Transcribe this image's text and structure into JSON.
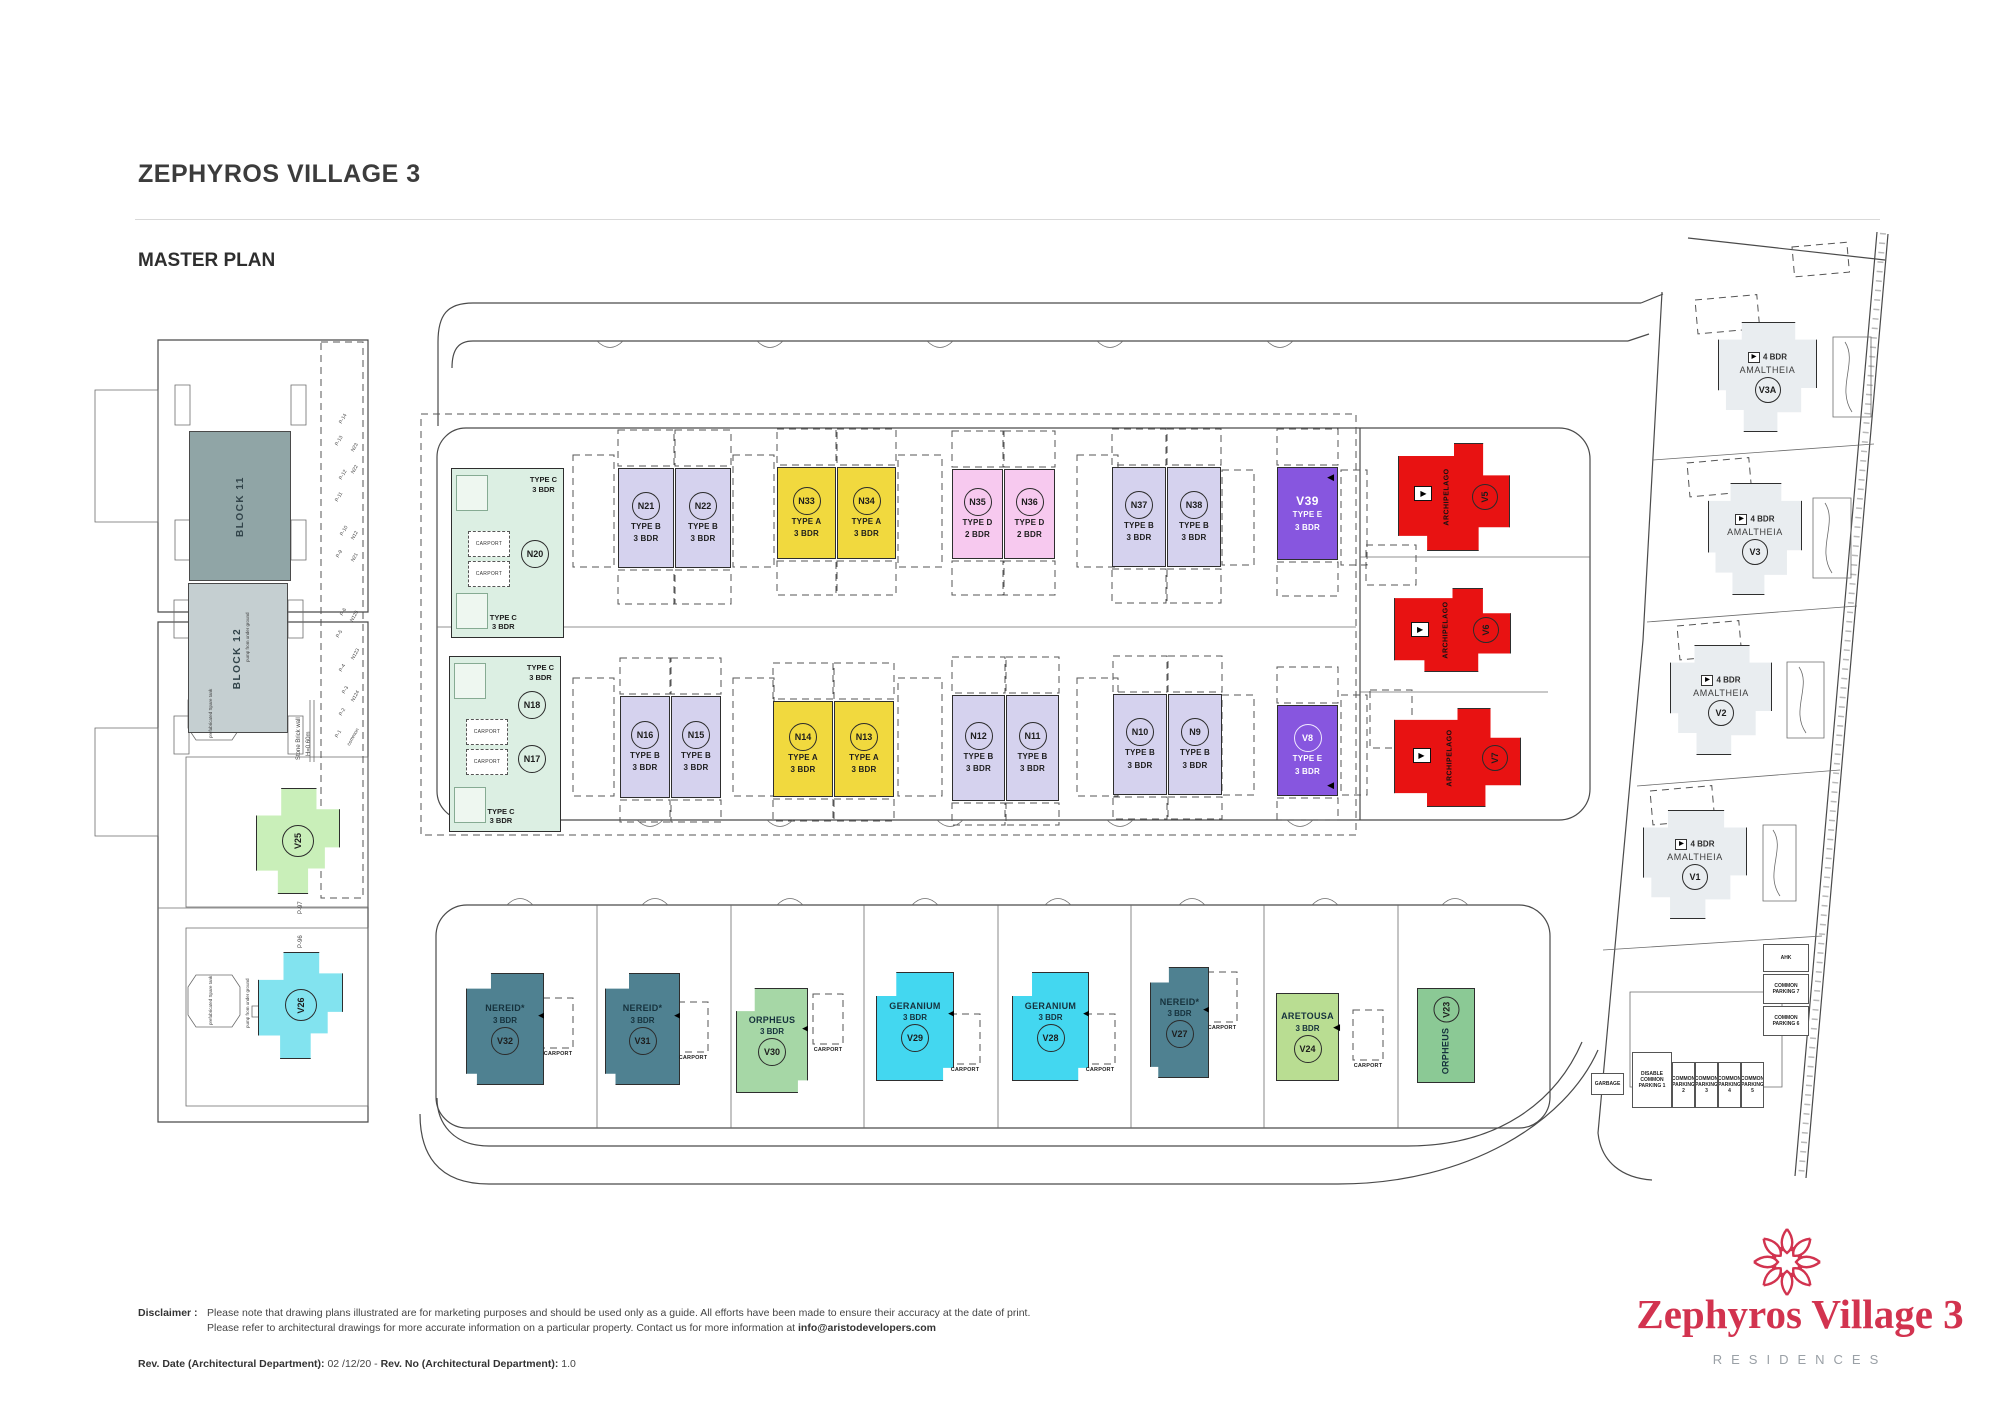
{
  "header": {
    "title": "ZEPHYROS VILLAGE 3",
    "subtitle": "MASTER PLAN"
  },
  "footer": {
    "disclaimer_label": "Disclaimer :",
    "disclaimer_line1": "Please note that drawing plans illustrated are for marketing purposes and should be used only as a guide. All efforts have been made to ensure their accuracy at the date of print.",
    "disclaimer_line2_pre": "Please refer to architectural drawings for more accurate information on a particular property. Contact us for more information at ",
    "disclaimer_email": "info@aristodevelopers.com",
    "rev_date_label": "Rev. Date (Architectural Department): ",
    "rev_date_value": "02 /12/20 - ",
    "rev_no_label": "Rev. No (Architectural Department): ",
    "rev_no_value": "1.0"
  },
  "logo": {
    "name": "Zephyros Village 3",
    "tagline": "RESIDENCES",
    "color": "#d2334f"
  },
  "plan": {
    "colors": {
      "A": "#f1d93e",
      "B": "#d5d2ee",
      "C": "#dcefe3",
      "D": "#f7c9ef",
      "E": "#8756df",
      "red": "#e81212",
      "nereid": "#4f8191",
      "orpheus": "#a6d7a6",
      "orpheus2": "#8bc995",
      "geranium": "#43d7f0",
      "aretousa": "#b9dd92",
      "v25": "#c9efb9",
      "v26": "#82e3ef",
      "amal": "#e9edf0",
      "block11": "#90a5a6",
      "block12": "#c5cfd1"
    },
    "carport_label": "CARPORT",
    "typec_label": [
      "TYPE C",
      "3 BDR"
    ],
    "typec_clusters": [
      {
        "x": 451,
        "y": 468,
        "w": 113,
        "h": 170,
        "codes": [
          "N20"
        ]
      },
      {
        "x": 449,
        "y": 656,
        "w": 112,
        "h": 176,
        "codes": [
          "N18",
          "N17"
        ]
      }
    ],
    "blocks": [
      {
        "label": "BLOCK 11",
        "x": 189,
        "y": 431,
        "w": 102,
        "h": 150,
        "color": "block11"
      },
      {
        "label": "BLOCK 12",
        "x": 188,
        "y": 583,
        "w": 100,
        "h": 150,
        "color": "block12"
      }
    ],
    "units": [
      {
        "code": "N21",
        "kind": "row",
        "deck": true,
        "x": 618,
        "y": 468,
        "w": 56,
        "h": 100,
        "color": "B",
        "lines": [
          "TYPE B",
          "3 BDR"
        ]
      },
      {
        "code": "N22",
        "kind": "row",
        "deck": true,
        "x": 675,
        "y": 468,
        "w": 56,
        "h": 100,
        "color": "B",
        "lines": [
          "TYPE B",
          "3 BDR"
        ]
      },
      {
        "code": "N33",
        "kind": "row",
        "deck": true,
        "x": 777,
        "y": 467,
        "w": 59,
        "h": 92,
        "color": "A",
        "lines": [
          "TYPE A",
          "3 BDR"
        ]
      },
      {
        "code": "N34",
        "kind": "row",
        "deck": true,
        "x": 837,
        "y": 467,
        "w": 59,
        "h": 92,
        "color": "A",
        "lines": [
          "TYPE A",
          "3 BDR"
        ]
      },
      {
        "code": "N35",
        "kind": "row",
        "deck": true,
        "x": 952,
        "y": 469,
        "w": 51,
        "h": 90,
        "color": "D",
        "lines": [
          "TYPE D",
          "2 BDR"
        ]
      },
      {
        "code": "N36",
        "kind": "row",
        "deck": true,
        "x": 1004,
        "y": 469,
        "w": 51,
        "h": 90,
        "color": "D",
        "lines": [
          "TYPE D",
          "2 BDR"
        ]
      },
      {
        "code": "N37",
        "kind": "row",
        "deck": true,
        "x": 1112,
        "y": 467,
        "w": 54,
        "h": 100,
        "color": "B",
        "lines": [
          "TYPE B",
          "3 BDR"
        ]
      },
      {
        "code": "N38",
        "kind": "row",
        "deck": true,
        "x": 1167,
        "y": 467,
        "w": 54,
        "h": 100,
        "color": "B",
        "lines": [
          "TYPE B",
          "3 BDR"
        ]
      },
      {
        "code": "V39",
        "kind": "row",
        "plain": true,
        "light": true,
        "deck": true,
        "x": 1277,
        "y": 467,
        "w": 61,
        "h": 93,
        "color": "E",
        "lines": [
          "TYPE E",
          "3 BDR"
        ],
        "arrow": "tr"
      },
      {
        "code": "N16",
        "kind": "row",
        "deck": true,
        "x": 620,
        "y": 696,
        "w": 50,
        "h": 102,
        "color": "B",
        "lines": [
          "TYPE B",
          "3 BDR"
        ]
      },
      {
        "code": "N15",
        "kind": "row",
        "deck": true,
        "x": 671,
        "y": 696,
        "w": 50,
        "h": 102,
        "color": "B",
        "lines": [
          "TYPE B",
          "3 BDR"
        ]
      },
      {
        "code": "N14",
        "kind": "row",
        "deck": true,
        "x": 773,
        "y": 701,
        "w": 60,
        "h": 96,
        "color": "A",
        "lines": [
          "TYPE A",
          "3 BDR"
        ]
      },
      {
        "code": "N13",
        "kind": "row",
        "deck": true,
        "x": 834,
        "y": 701,
        "w": 60,
        "h": 96,
        "color": "A",
        "lines": [
          "TYPE A",
          "3 BDR"
        ]
      },
      {
        "code": "N12",
        "kind": "row",
        "deck": true,
        "x": 952,
        "y": 695,
        "w": 53,
        "h": 106,
        "color": "B",
        "lines": [
          "TYPE B",
          "3 BDR"
        ]
      },
      {
        "code": "N11",
        "kind": "row",
        "deck": true,
        "x": 1006,
        "y": 695,
        "w": 53,
        "h": 106,
        "color": "B",
        "lines": [
          "TYPE B",
          "3 BDR"
        ]
      },
      {
        "code": "N10",
        "kind": "row",
        "deck": true,
        "x": 1113,
        "y": 694,
        "w": 54,
        "h": 101,
        "color": "B",
        "lines": [
          "TYPE B",
          "3 BDR"
        ]
      },
      {
        "code": "N9",
        "kind": "row",
        "deck": true,
        "x": 1168,
        "y": 694,
        "w": 54,
        "h": 101,
        "color": "B",
        "lines": [
          "TYPE B",
          "3 BDR"
        ]
      },
      {
        "code": "V8",
        "kind": "row",
        "light": true,
        "deck": true,
        "x": 1277,
        "y": 705,
        "w": 61,
        "h": 91,
        "color": "E",
        "lines": [
          "TYPE E",
          "3 BDR"
        ],
        "arrow": "br"
      },
      {
        "code": "V5",
        "kind": "red",
        "x": 1398,
        "y": 443,
        "w": 112,
        "h": 108,
        "color": "red",
        "name": "ARCHIPELAGO",
        "shape": "redshape"
      },
      {
        "code": "V6",
        "kind": "red",
        "x": 1394,
        "y": 588,
        "w": 117,
        "h": 84,
        "color": "red",
        "name": "ARCHIPELAGO",
        "shape": "redshape"
      },
      {
        "code": "V7",
        "kind": "red",
        "x": 1394,
        "y": 708,
        "w": 127,
        "h": 99,
        "color": "red",
        "name": "ARCHIPELAGO",
        "shape": "redshape"
      },
      {
        "code": "V32",
        "kind": "villa",
        "x": 466,
        "y": 973,
        "w": 78,
        "h": 112,
        "color": "nereid",
        "lines": [
          "NEREID*",
          "3 BDR"
        ],
        "shape": "villa",
        "arrow": "right"
      },
      {
        "code": "V31",
        "kind": "villa",
        "x": 605,
        "y": 973,
        "w": 75,
        "h": 112,
        "color": "nereid",
        "lines": [
          "NEREID*",
          "3 BDR"
        ],
        "shape": "villa",
        "arrow": "right"
      },
      {
        "code": "V30",
        "kind": "villa",
        "x": 736,
        "y": 988,
        "w": 72,
        "h": 105,
        "color": "orpheus",
        "lines": [
          "ORPHEUS",
          "3 BDR"
        ],
        "shape": "villa2",
        "arrow": "right"
      },
      {
        "code": "V29",
        "kind": "villa",
        "x": 876,
        "y": 972,
        "w": 78,
        "h": 109,
        "color": "geranium",
        "lines": [
          "GERANIUM",
          "3 BDR"
        ],
        "shape": "villa2",
        "arrow": "right"
      },
      {
        "code": "V28",
        "kind": "villa",
        "x": 1012,
        "y": 972,
        "w": 77,
        "h": 109,
        "color": "geranium",
        "lines": [
          "GERANIUM",
          "3 BDR"
        ],
        "shape": "villa2",
        "arrow": "right"
      },
      {
        "code": "V27",
        "kind": "villa",
        "x": 1150,
        "y": 967,
        "w": 59,
        "h": 111,
        "color": "nereid",
        "lines": [
          "NEREID*",
          "3 BDR"
        ],
        "shape": "villa",
        "arrow": "right"
      },
      {
        "code": "V24",
        "kind": "villa",
        "x": 1276,
        "y": 993,
        "w": 63,
        "h": 88,
        "color": "aretousa",
        "lines": [
          "ARETOUSA",
          "3 BDR"
        ],
        "arrow": "right"
      },
      {
        "code": "V23",
        "kind": "vert",
        "x": 1417,
        "y": 988,
        "w": 58,
        "h": 95,
        "color": "orpheus2",
        "name": "ORPHEUS"
      },
      {
        "code": "V25",
        "kind": "cross",
        "x": 256,
        "y": 788,
        "w": 84,
        "h": 106,
        "color": "v25",
        "shape": "cross"
      },
      {
        "code": "V26",
        "kind": "cross",
        "x": 258,
        "y": 952,
        "w": 85,
        "h": 107,
        "color": "v26",
        "shape": "cross"
      },
      {
        "code": "V3A",
        "kind": "amal",
        "x": 1718,
        "y": 322,
        "w": 99,
        "h": 110,
        "color": "amal",
        "lines": [
          "4 BDR",
          "AMALTHEIA"
        ],
        "shape": "amal"
      },
      {
        "code": "V3",
        "kind": "amal",
        "x": 1708,
        "y": 483,
        "w": 94,
        "h": 112,
        "color": "amal",
        "lines": [
          "4 BDR",
          "AMALTHEIA"
        ],
        "shape": "amal"
      },
      {
        "code": "V2",
        "kind": "amal",
        "x": 1670,
        "y": 645,
        "w": 102,
        "h": 110,
        "color": "amal",
        "lines": [
          "4 BDR",
          "AMALTHEIA"
        ],
        "shape": "amal"
      },
      {
        "code": "V1",
        "kind": "amal",
        "x": 1643,
        "y": 810,
        "w": 104,
        "h": 109,
        "color": "amal",
        "lines": [
          "4 BDR",
          "AMALTHEIA"
        ],
        "shape": "amal"
      }
    ],
    "carports": [
      {
        "x": 558,
        "y": 1054
      },
      {
        "x": 693,
        "y": 1058
      },
      {
        "x": 828,
        "y": 1050
      },
      {
        "x": 965,
        "y": 1070
      },
      {
        "x": 1100,
        "y": 1070
      },
      {
        "x": 1222,
        "y": 1028
      },
      {
        "x": 1368,
        "y": 1066
      }
    ],
    "parking_boxes": [
      {
        "text": "AHK",
        "x": 1763,
        "y": 944,
        "w": 46,
        "h": 28
      },
      {
        "text": "COMMON PARKING 7",
        "x": 1763,
        "y": 974,
        "w": 46,
        "h": 30
      },
      {
        "text": "COMMON PARKING 6",
        "x": 1763,
        "y": 1006,
        "w": 46,
        "h": 30
      },
      {
        "text": "GARBAGE",
        "x": 1591,
        "y": 1073,
        "w": 33,
        "h": 22
      },
      {
        "text": "DISABLE COMMON PARKING 1",
        "x": 1632,
        "y": 1052,
        "w": 40,
        "h": 56
      },
      {
        "text": "COMMON PARKING 2",
        "x": 1672,
        "y": 1062,
        "w": 23,
        "h": 46
      },
      {
        "text": "COMMON PARKING 3",
        "x": 1695,
        "y": 1062,
        "w": 23,
        "h": 46
      },
      {
        "text": "COMMON PARKING 4",
        "x": 1718,
        "y": 1062,
        "w": 23,
        "h": 46
      },
      {
        "text": "COMMON PARKING 5",
        "x": 1741,
        "y": 1062,
        "w": 23,
        "h": 46
      }
    ],
    "small_labels": [
      {
        "t": "Stone Brick wall",
        "x": 296,
        "y": 760,
        "r": -90,
        "s": 6
      },
      {
        "t": "H=0.60m",
        "x": 306,
        "y": 756,
        "r": -90,
        "s": 6
      },
      {
        "t": "P-97",
        "x": 298,
        "y": 914,
        "r": -90,
        "s": 6
      },
      {
        "t": "P-96",
        "x": 298,
        "y": 948,
        "r": -90,
        "s": 6
      },
      {
        "t": "common",
        "x": 346,
        "y": 744,
        "r": -60,
        "s": 5
      },
      {
        "t": "P-1",
        "x": 334,
        "y": 736,
        "r": -60,
        "s": 5
      },
      {
        "t": "P-2",
        "x": 338,
        "y": 714,
        "r": -60,
        "s": 5
      },
      {
        "t": "P-3",
        "x": 341,
        "y": 692,
        "r": -60,
        "s": 5
      },
      {
        "t": "P-4",
        "x": 338,
        "y": 670,
        "r": -60,
        "s": 5
      },
      {
        "t": "N124",
        "x": 350,
        "y": 700,
        "r": -60,
        "s": 5
      },
      {
        "t": "P-5",
        "x": 335,
        "y": 636,
        "r": -60,
        "s": 5
      },
      {
        "t": "P-6",
        "x": 339,
        "y": 614,
        "r": -60,
        "s": 5
      },
      {
        "t": "N123",
        "x": 350,
        "y": 658,
        "r": -60,
        "s": 5
      },
      {
        "t": "N125",
        "x": 349,
        "y": 620,
        "r": -60,
        "s": 5
      },
      {
        "t": "P-9",
        "x": 335,
        "y": 556,
        "r": -60,
        "s": 5
      },
      {
        "t": "P-10",
        "x": 339,
        "y": 534,
        "r": -60,
        "s": 5
      },
      {
        "t": "N21",
        "x": 350,
        "y": 560,
        "r": -60,
        "s": 5
      },
      {
        "t": "N12",
        "x": 350,
        "y": 538,
        "r": -60,
        "s": 5
      },
      {
        "t": "P-11",
        "x": 334,
        "y": 500,
        "r": -60,
        "s": 5
      },
      {
        "t": "P-12",
        "x": 338,
        "y": 478,
        "r": -60,
        "s": 5
      },
      {
        "t": "N22",
        "x": 350,
        "y": 472,
        "r": -60,
        "s": 5
      },
      {
        "t": "P-13",
        "x": 334,
        "y": 444,
        "r": -60,
        "s": 5
      },
      {
        "t": "P-14",
        "x": 338,
        "y": 422,
        "r": -60,
        "s": 5
      },
      {
        "t": "N23",
        "x": 350,
        "y": 450,
        "r": -60,
        "s": 5
      },
      {
        "t": "prefabricated Spare tank",
        "x": 208,
        "y": 738,
        "r": -90,
        "s": 4.5
      },
      {
        "t": "prefabricated Spare tank",
        "x": 208,
        "y": 1025,
        "r": -90,
        "s": 4.5
      },
      {
        "t": "pump from under ground",
        "x": 245,
        "y": 662,
        "r": -90,
        "s": 4.5
      },
      {
        "t": "pump from under ground",
        "x": 245,
        "y": 1028,
        "r": -90,
        "s": 4.5
      }
    ],
    "hatches": [
      {
        "x": 573,
        "y": 455,
        "w": 41,
        "h": 112
      },
      {
        "x": 733,
        "y": 455,
        "w": 41,
        "h": 112
      },
      {
        "x": 898,
        "y": 455,
        "w": 44,
        "h": 112
      },
      {
        "x": 1077,
        "y": 455,
        "w": 41,
        "h": 112
      },
      {
        "x": 1222,
        "y": 470,
        "w": 32,
        "h": 95
      },
      {
        "x": 1341,
        "y": 470,
        "w": 26,
        "h": 95
      },
      {
        "x": 573,
        "y": 678,
        "w": 41,
        "h": 118
      },
      {
        "x": 733,
        "y": 678,
        "w": 41,
        "h": 118
      },
      {
        "x": 898,
        "y": 678,
        "w": 44,
        "h": 118
      },
      {
        "x": 1077,
        "y": 678,
        "w": 41,
        "h": 118
      },
      {
        "x": 1222,
        "y": 695,
        "w": 32,
        "h": 100
      },
      {
        "x": 1341,
        "y": 695,
        "w": 26,
        "h": 100
      },
      {
        "x": 1366,
        "y": 545,
        "w": 50,
        "h": 40
      },
      {
        "x": 1370,
        "y": 690,
        "w": 42,
        "h": 58
      },
      {
        "x": 321,
        "y": 342,
        "w": 42,
        "h": 556
      },
      {
        "x": 1695,
        "y": 300,
        "w": 62,
        "h": 34,
        "r": -5
      },
      {
        "x": 1687,
        "y": 463,
        "w": 62,
        "h": 34,
        "r": -5
      },
      {
        "x": 1677,
        "y": 626,
        "w": 62,
        "h": 34,
        "r": -5
      },
      {
        "x": 1650,
        "y": 791,
        "w": 62,
        "h": 34,
        "r": -5
      },
      {
        "x": 1792,
        "y": 247,
        "w": 55,
        "h": 30,
        "r": -5
      }
    ]
  }
}
